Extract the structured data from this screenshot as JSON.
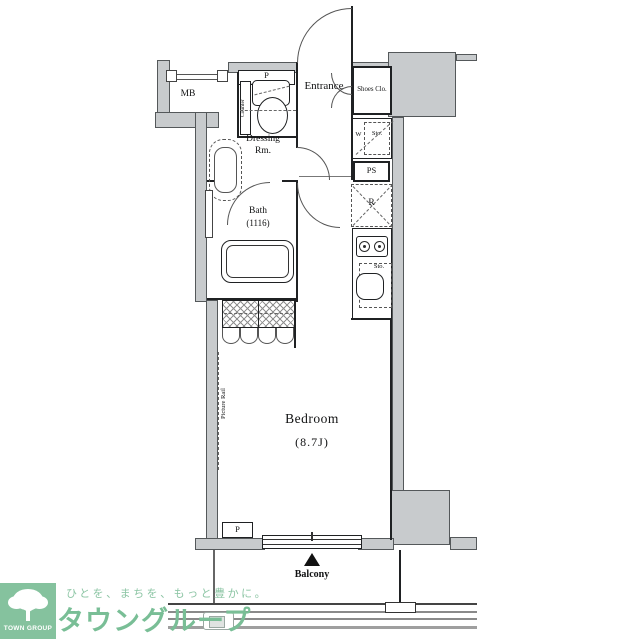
{
  "plan": {
    "labels": {
      "mb": "MB",
      "p_top": "P",
      "counter": "Counter",
      "sink": "Sink",
      "entrance": "Entrance",
      "shoes_closet": "Shoes Clo.",
      "washer": "W",
      "storage_entry": "Sto.",
      "pipe_space": "PS",
      "refrigerator": "R",
      "dressing_line1": "Dressing",
      "dressing_line2": "Rm.",
      "bath": "Bath",
      "bath_size": "(1116)",
      "kitchen_storage": "Sto.",
      "bedroom": "Bedroom",
      "bedroom_size": "(8.7J)",
      "picture_rail": "Picture Rail",
      "p_bottom": "P",
      "balcony": "Balcony"
    },
    "colors": {
      "wall_gray": "#c8cbcd"
    }
  },
  "footer": {
    "logo_name": "TOWN GROUP",
    "tagline": "ひとを、まちを、もっと豊かに。",
    "brand": "タウングループ",
    "colors": {
      "logo_bg": "#85c29e",
      "brand_text": "#79be96",
      "tagline_text": "#8cc5a4"
    }
  }
}
